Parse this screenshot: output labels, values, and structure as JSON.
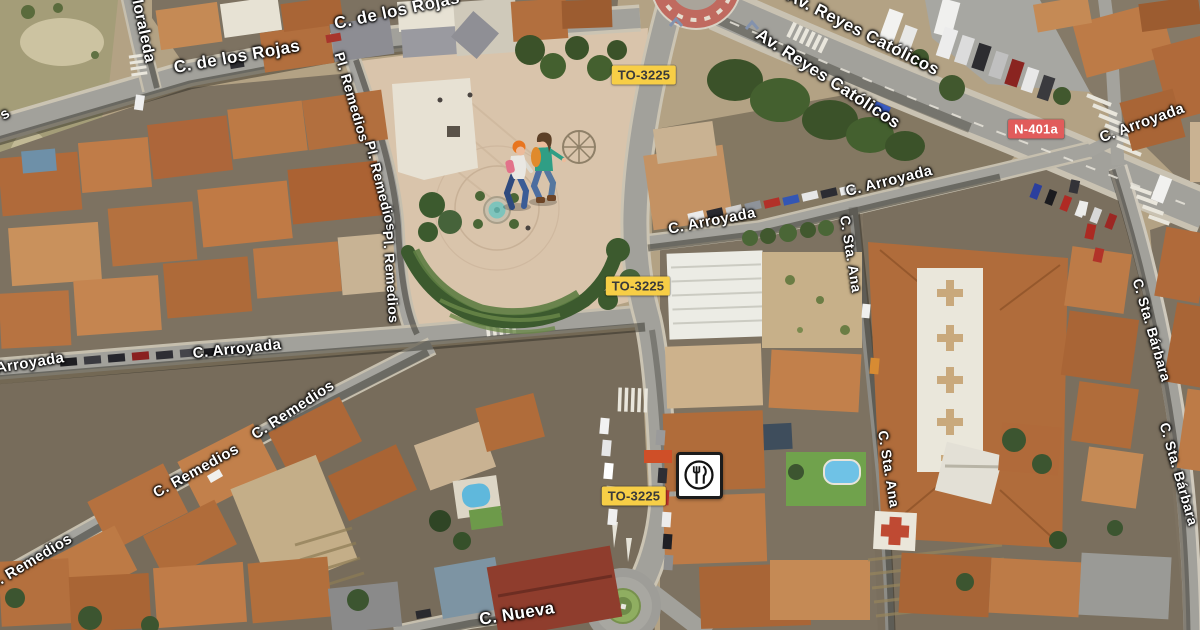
{
  "map": {
    "view_type": "satellite",
    "label_style": {
      "color": "#FFFFFF",
      "halo": "#000000"
    },
    "road_labels": [
      {
        "text": "Moraleda",
        "x": 142,
        "y": 27,
        "rot": 78,
        "fs": 16
      },
      {
        "text": "C. de los Rojas",
        "x": 237,
        "y": 57,
        "rot": -10,
        "fs": 17
      },
      {
        "text": "C. de los Rojas",
        "x": 397,
        "y": 11,
        "rot": -12,
        "fs": 17
      },
      {
        "text": "Av. Reyes Católicos",
        "x": 863,
        "y": 33,
        "rot": 27,
        "fs": 17
      },
      {
        "text": "Av. Reyes Católicos",
        "x": 828,
        "y": 79,
        "rot": 33,
        "fs": 17
      },
      {
        "text": "C. Arroyada",
        "x": 1142,
        "y": 123,
        "rot": -20,
        "fs": 15
      },
      {
        "text": "C. Arroyada",
        "x": 889,
        "y": 181,
        "rot": -14,
        "fs": 15
      },
      {
        "text": "C. Arroyada",
        "x": 712,
        "y": 221,
        "rot": -11,
        "fs": 15
      },
      {
        "text": "C. Arroyada",
        "x": 237,
        "y": 349,
        "rot": -6,
        "fs": 15
      },
      {
        "text": "Arroyada",
        "x": 30,
        "y": 363,
        "rot": -9,
        "fs": 15
      },
      {
        "text": "C. Remedios",
        "x": 293,
        "y": 410,
        "rot": -33,
        "fs": 15
      },
      {
        "text": "C. Remedios",
        "x": 196,
        "y": 471,
        "rot": -29,
        "fs": 15
      },
      {
        "text": "C. Remedios",
        "x": 30,
        "y": 562,
        "rot": -31,
        "fs": 15
      },
      {
        "text": "Pl. Remedios",
        "x": 352,
        "y": 97,
        "rot": 74,
        "fs": 14
      },
      {
        "text": "Pl. Remedios",
        "x": 381,
        "y": 186,
        "rot": 76,
        "fs": 14
      },
      {
        "text": "Pl. Remedios",
        "x": 391,
        "y": 277,
        "rot": 86,
        "fs": 14
      },
      {
        "text": "C. Sta. Ana",
        "x": 851,
        "y": 254,
        "rot": 81,
        "fs": 14
      },
      {
        "text": "C. Sta. Ana",
        "x": 889,
        "y": 469,
        "rot": 81,
        "fs": 14
      },
      {
        "text": "C. Sta. Bárbara",
        "x": 1152,
        "y": 330,
        "rot": 74,
        "fs": 14
      },
      {
        "text": "C. Sta. Bárbara",
        "x": 1179,
        "y": 474,
        "rot": 74,
        "fs": 14
      },
      {
        "text": "C. Nueva",
        "x": 517,
        "y": 614,
        "rot": -9,
        "fs": 17
      },
      {
        "text": "s",
        "x": 5,
        "y": 114,
        "rot": -32,
        "fs": 15
      }
    ],
    "route_badges": [
      {
        "text": "TO-3225",
        "x": 644,
        "y": 75,
        "style": "regional"
      },
      {
        "text": "TO-3225",
        "x": 638,
        "y": 286,
        "style": "regional"
      },
      {
        "text": "TO-3225",
        "x": 634,
        "y": 496,
        "style": "regional"
      },
      {
        "text": "N-401a",
        "x": 1036,
        "y": 129,
        "style": "national"
      }
    ],
    "badge_styles": {
      "regional": {
        "bg": "#F7CE46",
        "text": "#3A3A3A"
      },
      "national": {
        "bg": "#E15C5B",
        "text": "#FFFFFF"
      }
    },
    "pois": [
      {
        "id": "restaurant",
        "icon": "fork-knife-icon",
        "x": 699,
        "y": 475
      }
    ]
  }
}
